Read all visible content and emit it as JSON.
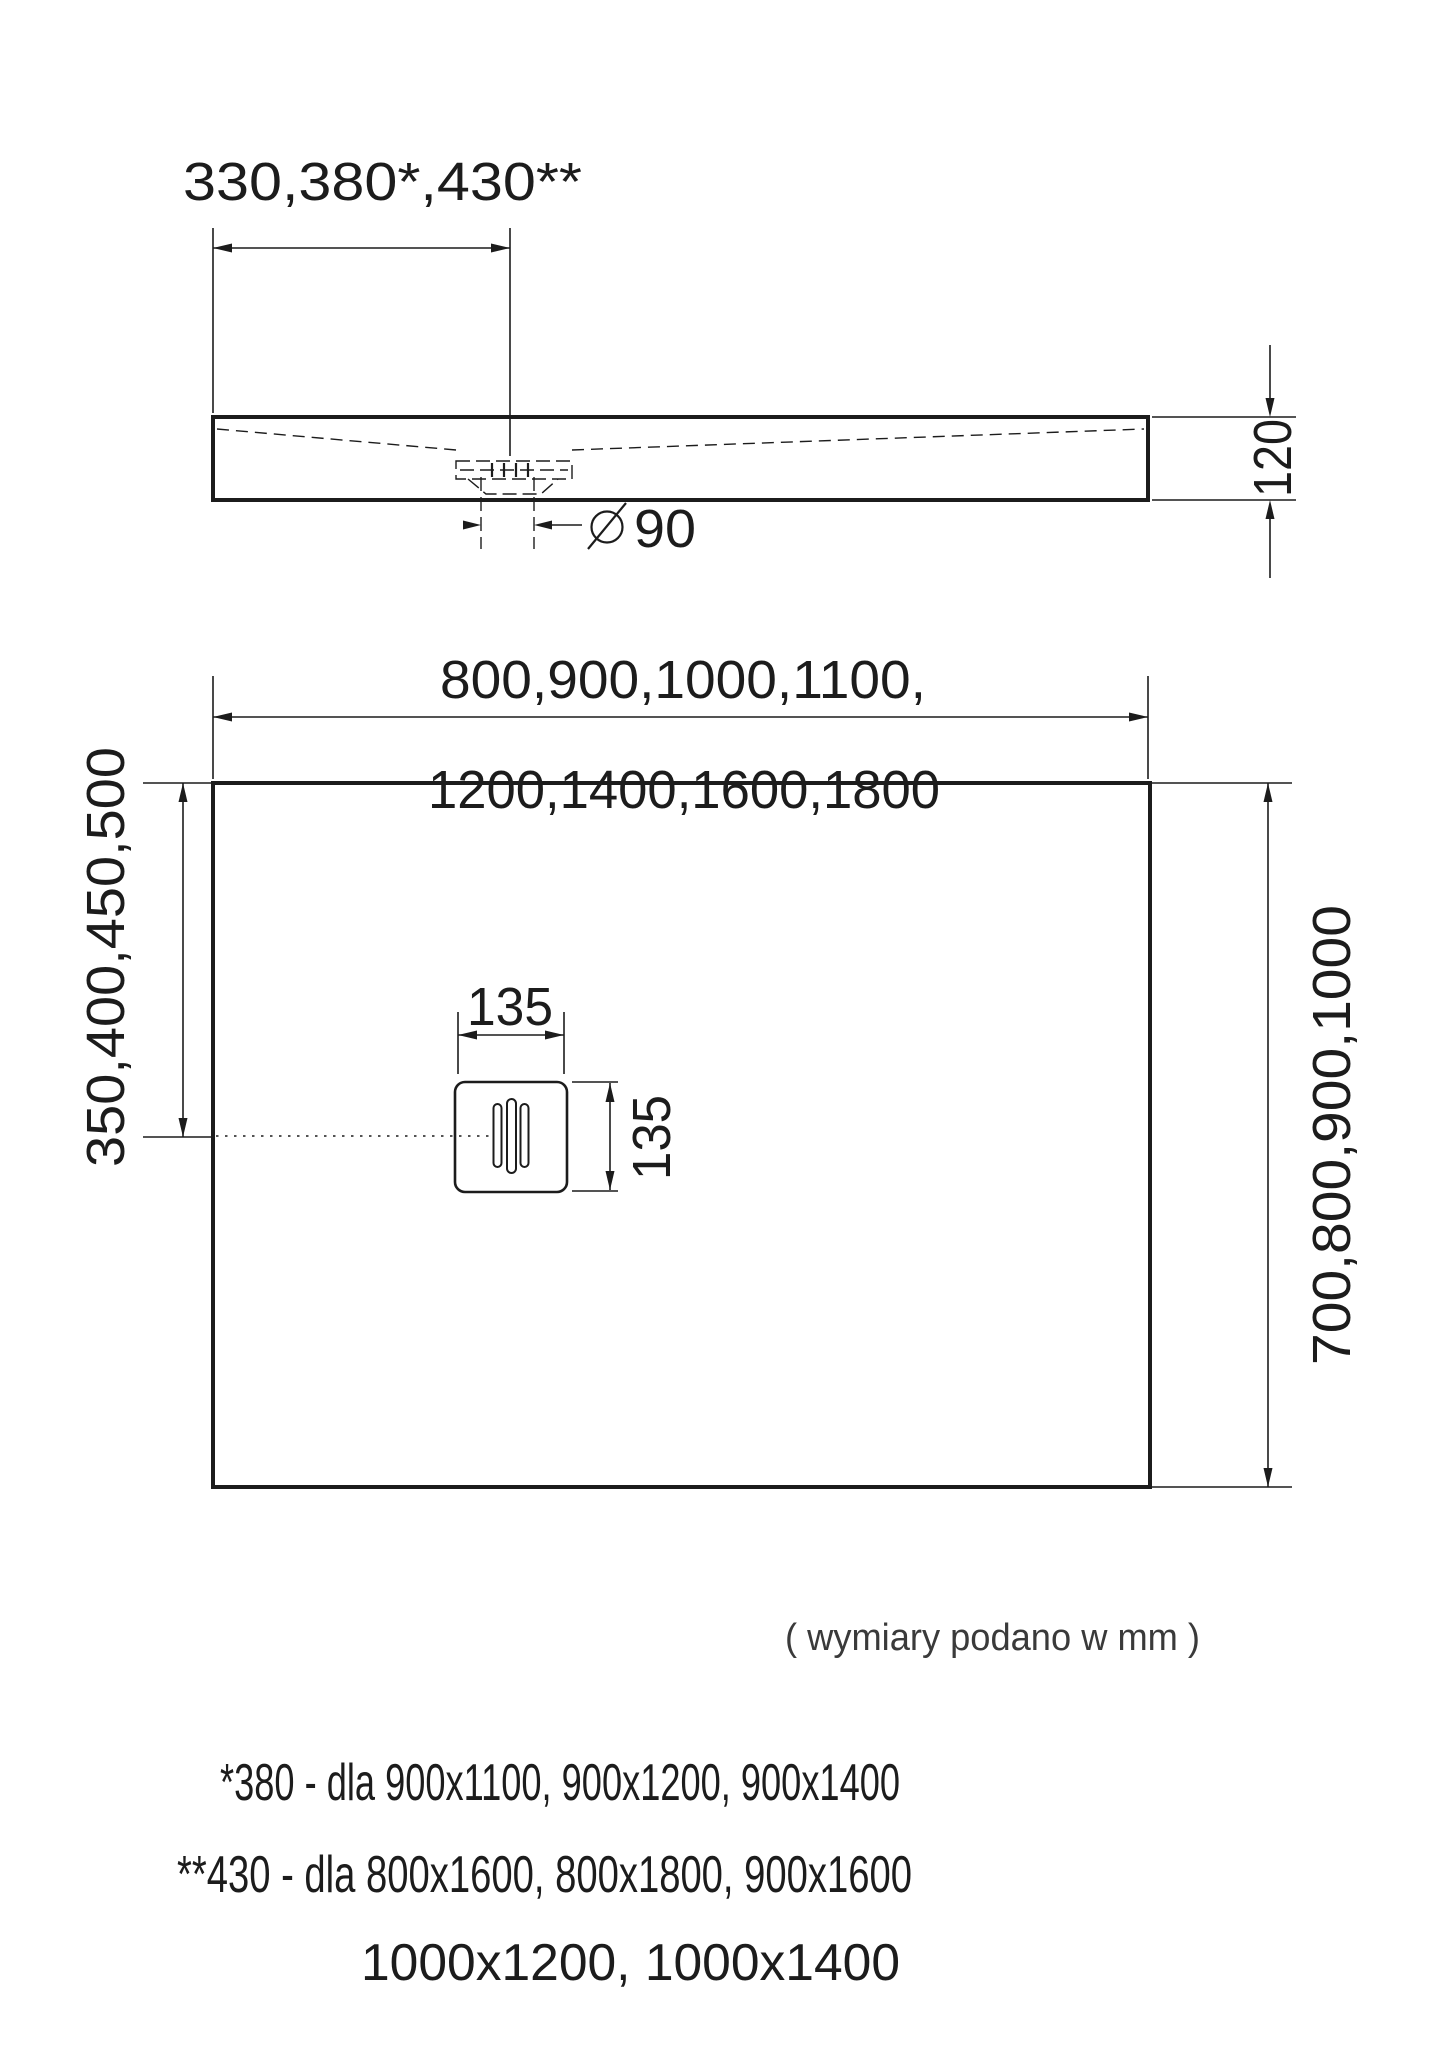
{
  "side_view": {
    "width_dim_label": "330,380*,430**",
    "height_dim_label": "120",
    "drain_diameter_value": "90"
  },
  "plan_view": {
    "width_dim_line1": "800,900,1000,1100,",
    "width_dim_line2": "1200,1400,1600,1800",
    "left_dim_label": "350,400,450,500",
    "right_dim_label": "700,800,900,1000",
    "drain_width_label": "135",
    "drain_height_label": "135"
  },
  "notes": {
    "units_note": "( wymiary podano w mm )",
    "footnote_line1": "*380 - dla 900x1100, 900x1200, 900x1400",
    "footnote_line2": "**430 - dla 800x1600, 800x1800, 900x1600",
    "footnote_line3": "1000x1200, 1000x1400"
  },
  "colors": {
    "line": "#1c1c1c",
    "note": "#3a3a3a",
    "background": "#ffffff"
  }
}
